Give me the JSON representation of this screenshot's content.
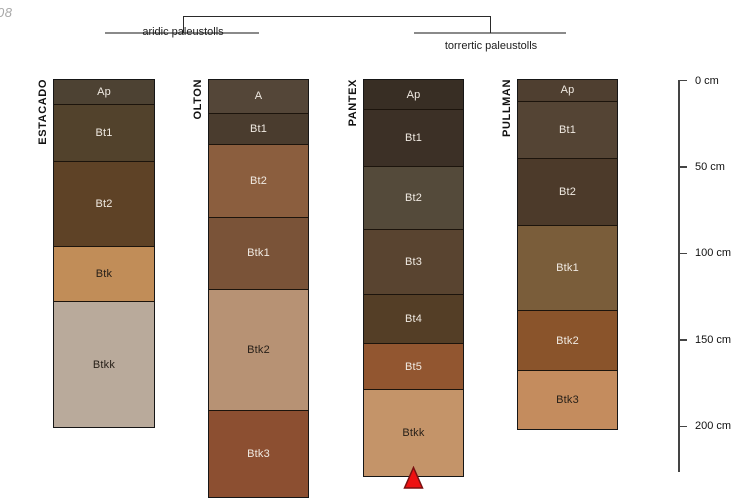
{
  "watermark": "08",
  "classification_tree": {
    "left_group": "aridic paleustolls",
    "right_group": "torrertic paleustolls"
  },
  "depth_scale": {
    "ticks": [
      {
        "cm": 0,
        "label": "0 cm"
      },
      {
        "cm": 50,
        "label": "50 cm"
      },
      {
        "cm": 100,
        "label": "100 cm"
      },
      {
        "cm": 150,
        "label": "150 cm"
      },
      {
        "cm": 200,
        "label": "200 cm"
      }
    ]
  },
  "marker": {
    "color": "#ee1111",
    "outline": "#7a1010"
  },
  "profiles": [
    {
      "name": "ESTACADO",
      "horizons": [
        {
          "label": "Ap",
          "color": "#4D4233",
          "top_cm": 0,
          "bottom_cm": 14
        },
        {
          "label": "Bt1",
          "color": "#52422C",
          "top_cm": 14,
          "bottom_cm": 47
        },
        {
          "label": "Bt2",
          "color": "#5E4226",
          "top_cm": 47,
          "bottom_cm": 96
        },
        {
          "label": "Btk",
          "color": "#C18D58",
          "top_cm": 96,
          "bottom_cm": 128
        },
        {
          "label": "Btkk",
          "color": "#B9AA9B",
          "top_cm": 128,
          "bottom_cm": 201
        }
      ]
    },
    {
      "name": "OLTON",
      "horizons": [
        {
          "label": "A",
          "color": "#544638",
          "top_cm": 0,
          "bottom_cm": 19
        },
        {
          "label": "Bt1",
          "color": "#4A3C2E",
          "top_cm": 19,
          "bottom_cm": 37
        },
        {
          "label": "Bt2",
          "color": "#8B5E3E",
          "top_cm": 37,
          "bottom_cm": 79
        },
        {
          "label": "Btk1",
          "color": "#7A5338",
          "top_cm": 79,
          "bottom_cm": 121
        },
        {
          "label": "Btk2",
          "color": "#B79274",
          "top_cm": 121,
          "bottom_cm": 191
        },
        {
          "label": "Btk3",
          "color": "#8C4F31",
          "top_cm": 191,
          "bottom_cm": 241
        }
      ]
    },
    {
      "name": "PANTEX",
      "horizons": [
        {
          "label": "Ap",
          "color": "#382E24",
          "top_cm": 0,
          "bottom_cm": 17
        },
        {
          "label": "Bt1",
          "color": "#3C3026",
          "top_cm": 17,
          "bottom_cm": 50
        },
        {
          "label": "Bt2",
          "color": "#544A3A",
          "top_cm": 50,
          "bottom_cm": 86
        },
        {
          "label": "Bt3",
          "color": "#594430",
          "top_cm": 86,
          "bottom_cm": 124
        },
        {
          "label": "Bt4",
          "color": "#543E26",
          "top_cm": 124,
          "bottom_cm": 152
        },
        {
          "label": "Bt5",
          "color": "#925630",
          "top_cm": 152,
          "bottom_cm": 179
        },
        {
          "label": "Btkk",
          "color": "#C49469",
          "top_cm": 179,
          "bottom_cm": 229
        }
      ]
    },
    {
      "name": "PULLMAN",
      "horizons": [
        {
          "label": "Ap",
          "color": "#4F3F30",
          "top_cm": 0,
          "bottom_cm": 12
        },
        {
          "label": "Bt1",
          "color": "#544434",
          "top_cm": 12,
          "bottom_cm": 45
        },
        {
          "label": "Bt2",
          "color": "#4C3A2A",
          "top_cm": 45,
          "bottom_cm": 84
        },
        {
          "label": "Btk1",
          "color": "#7A5D3A",
          "top_cm": 84,
          "bottom_cm": 133
        },
        {
          "label": "Btk2",
          "color": "#8A542B",
          "top_cm": 133,
          "bottom_cm": 168
        },
        {
          "label": "Btk3",
          "color": "#C48C5E",
          "top_cm": 168,
          "bottom_cm": 202
        }
      ]
    }
  ]
}
